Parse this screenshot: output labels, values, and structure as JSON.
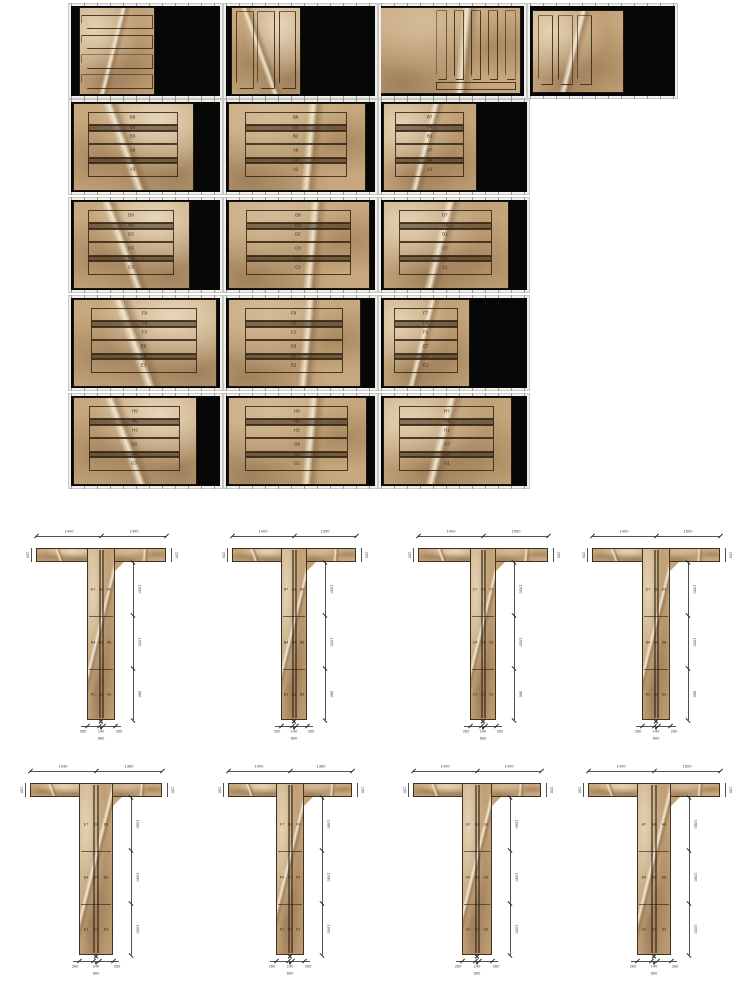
{
  "page": {
    "width": 750,
    "height": 1000,
    "background": "#ffffff",
    "description": "Stone cladding shop drawing: slab cutting layout sheets (top) and T-shaped column cladding elevations (bottom)"
  },
  "colors": {
    "slab_base": "#c7a87e",
    "slab_dark": "#8a6844",
    "slab_light": "#e8d9bc",
    "vein": "#f6ecd6",
    "outline": "#342512",
    "black_background": "#070707",
    "frame": "#f0efeb",
    "frame_tick": "#9a9a94",
    "dim_line": "#55504a",
    "dim_text": "#4a463f",
    "strip_label_text": "#33261a",
    "page_background": "#ffffff"
  },
  "slab_grid": {
    "rows": [
      {
        "kind": "unlabeled",
        "cells": [
          {
            "x": 68,
            "y": 3,
            "w": 155,
            "h": 96,
            "slab": {
              "l": 6,
              "t": 2,
              "w": 50,
              "h": 96
            },
            "shape": {
              "kind": "hstrips",
              "count": 4,
              "box": {
                "l": 2,
                "t": 8,
                "w": 96,
                "h": 86
              },
              "chamfer": "left"
            }
          },
          {
            "x": 223,
            "y": 3,
            "w": 155,
            "h": 96,
            "slab": {
              "l": 4,
              "t": 2,
              "w": 46,
              "h": 96
            },
            "shape": {
              "kind": "vstrips",
              "count": 3,
              "box": {
                "l": 6,
                "t": 4,
                "w": 88,
                "h": 90
              },
              "chamfer": "bottom"
            }
          },
          {
            "x": 378,
            "y": 3,
            "w": 149,
            "h": 96,
            "slab": {
              "l": 0,
              "t": 2,
              "w": 97,
              "h": 95
            },
            "shape": {
              "kind": "vstrips",
              "count": 5,
              "box": {
                "l": 40,
                "t": 3,
                "w": 57,
                "h": 82
              },
              "chamfer": "bottom",
              "base_bar": {
                "l": 40,
                "t": 87,
                "w": 57,
                "h": 9
              }
            }
          },
          {
            "x": 527,
            "y": 3,
            "w": 151,
            "h": 96,
            "slab": {
              "l": 2,
              "t": 5,
              "w": 62,
              "h": 90
            },
            "shape": {
              "kind": "vstrips",
              "count": 3,
              "box": {
                "l": 6,
                "t": 6,
                "w": 60,
                "h": 86
              },
              "chamfer": "bottom"
            }
          }
        ]
      },
      {
        "kind": "labeled",
        "cells": [
          {
            "x": 68,
            "y": 99,
            "w": 155,
            "h": 96,
            "slab": {
              "l": 2,
              "t": 2,
              "w": 80,
              "h": 96
            },
            "strips": [
              "B9",
              "B6",
              "B3",
              "A9",
              "A6",
              "A3"
            ]
          },
          {
            "x": 223,
            "y": 99,
            "w": 155,
            "h": 96,
            "slab": {
              "l": 2,
              "t": 2,
              "w": 91,
              "h": 96
            },
            "strips": [
              "B8",
              "B5",
              "B2",
              "A8",
              "A5",
              "A2"
            ]
          },
          {
            "x": 378,
            "y": 99,
            "w": 152,
            "h": 96,
            "slab": {
              "l": 2,
              "t": 2,
              "w": 63,
              "h": 96
            },
            "strips": [
              "B7",
              "B4",
              "B1",
              "A7",
              "A4",
              "A1"
            ]
          }
        ]
      },
      {
        "kind": "labeled",
        "cells": [
          {
            "x": 68,
            "y": 197,
            "w": 155,
            "h": 96,
            "slab": {
              "l": 2,
              "t": 2,
              "w": 77,
              "h": 96
            },
            "strips": [
              "D9",
              "D6",
              "D3",
              "C9",
              "C6",
              "C3"
            ]
          },
          {
            "x": 223,
            "y": 197,
            "w": 155,
            "h": 96,
            "slab": {
              "l": 2,
              "t": 2,
              "w": 94,
              "h": 96
            },
            "strips": [
              "D8",
              "D5",
              "D2",
              "C8",
              "C5",
              "C2"
            ]
          },
          {
            "x": 378,
            "y": 197,
            "w": 152,
            "h": 96,
            "slab": {
              "l": 2,
              "t": 2,
              "w": 85,
              "h": 96
            },
            "strips": [
              "D7",
              "D4",
              "D1",
              "C7",
              "C4",
              "C1"
            ]
          }
        ]
      },
      {
        "kind": "labeled",
        "cells": [
          {
            "x": 68,
            "y": 295,
            "w": 155,
            "h": 96,
            "slab": {
              "l": 2,
              "t": 2,
              "w": 95,
              "h": 96
            },
            "strips": [
              "F9",
              "F6",
              "F3",
              "E9",
              "E6",
              "E3"
            ]
          },
          {
            "x": 223,
            "y": 295,
            "w": 155,
            "h": 96,
            "slab": {
              "l": 2,
              "t": 2,
              "w": 88,
              "h": 96
            },
            "strips": [
              "F8",
              "F5",
              "F2",
              "E8",
              "E5",
              "E2"
            ]
          },
          {
            "x": 378,
            "y": 295,
            "w": 152,
            "h": 96,
            "slab": {
              "l": 2,
              "t": 2,
              "w": 58,
              "h": 96
            },
            "strips": [
              "F7",
              "F4",
              "F1",
              "E7",
              "E4",
              "E1"
            ]
          }
        ]
      },
      {
        "kind": "labeled",
        "cells": [
          {
            "x": 68,
            "y": 393,
            "w": 155,
            "h": 96,
            "slab": {
              "l": 2,
              "t": 2,
              "w": 82,
              "h": 96
            },
            "strips": [
              "H9",
              "H6",
              "H3",
              "G9",
              "G6",
              "G3"
            ]
          },
          {
            "x": 223,
            "y": 393,
            "w": 155,
            "h": 96,
            "slab": {
              "l": 2,
              "t": 2,
              "w": 92,
              "h": 96
            },
            "strips": [
              "H8",
              "H5",
              "H2",
              "G8",
              "G5",
              "G2"
            ]
          },
          {
            "x": 378,
            "y": 393,
            "w": 152,
            "h": 96,
            "slab": {
              "l": 2,
              "t": 2,
              "w": 87,
              "h": 96
            },
            "strips": [
              "H7",
              "H4",
              "H1",
              "G7",
              "G4",
              "G1"
            ]
          }
        ]
      }
    ]
  },
  "columns_section": {
    "rows": [
      {
        "tees": [
          {
            "x": 36,
            "y": 528,
            "w": 130,
            "h": 215,
            "stem_w": 28,
            "dims": {
              "left_arm": "1400",
              "right_arm": "1400",
              "flange": "150",
              "segments": [
                "1050",
                "1050",
                "980"
              ],
              "bottom": [
                "260",
                "140",
                "260"
              ],
              "total": "660"
            },
            "segments": [
              [
                "A7",
                "A8",
                "A9"
              ],
              [
                "A4",
                "A5",
                "A6"
              ],
              [
                "A1",
                "A2",
                "A3"
              ]
            ]
          },
          {
            "x": 232,
            "y": 528,
            "w": 124,
            "h": 215,
            "stem_w": 26,
            "dims": {
              "left_arm": "1400",
              "right_arm": "1350",
              "flange": "150",
              "segments": [
                "1050",
                "1050",
                "980"
              ],
              "bottom": [
                "260",
                "140",
                "260"
              ],
              "total": "660"
            },
            "segments": [
              [
                "B7",
                "B8",
                "B9"
              ],
              [
                "B4",
                "B5",
                "B6"
              ],
              [
                "B1",
                "B2",
                "B3"
              ]
            ]
          },
          {
            "x": 418,
            "y": 528,
            "w": 130,
            "h": 215,
            "stem_w": 26,
            "dims": {
              "left_arm": "1400",
              "right_arm": "1500",
              "flange": "150",
              "segments": [
                "1050",
                "1050",
                "980"
              ],
              "bottom": [
                "260",
                "140",
                "260"
              ],
              "total": "660"
            },
            "segments": [
              [
                "C7",
                "C8",
                "C9"
              ],
              [
                "C4",
                "C5",
                "C6"
              ],
              [
                "C1",
                "C2",
                "C3"
              ]
            ]
          },
          {
            "x": 592,
            "y": 528,
            "w": 128,
            "h": 215,
            "stem_w": 28,
            "dims": {
              "left_arm": "1400",
              "right_arm": "1500",
              "flange": "150",
              "segments": [
                "1050",
                "1050",
                "980"
              ],
              "bottom": [
                "260",
                "140",
                "260"
              ],
              "total": "660"
            },
            "segments": [
              [
                "D7",
                "D8",
                "D9"
              ],
              [
                "D4",
                "D5",
                "D6"
              ],
              [
                "D1",
                "D2",
                "D3"
              ]
            ]
          }
        ]
      },
      {
        "tees": [
          {
            "x": 30,
            "y": 763,
            "w": 132,
            "h": 215,
            "stem_w": 34,
            "dims": {
              "left_arm": "1430",
              "right_arm": "1380",
              "flange": "150",
              "segments": [
                "1080",
                "1080",
                "1000"
              ],
              "bottom": [
                "260",
                "140",
                "260"
              ],
              "total": "660"
            },
            "segments": [
              [
                "E7",
                "E8",
                "E9"
              ],
              [
                "E4",
                "E5",
                "E6"
              ],
              [
                "E1",
                "E2",
                "E3"
              ]
            ]
          },
          {
            "x": 228,
            "y": 763,
            "w": 124,
            "h": 215,
            "stem_w": 28,
            "dims": {
              "left_arm": "1400",
              "right_arm": "1380",
              "flange": "150",
              "segments": [
                "1080",
                "1080",
                "1000"
              ],
              "bottom": [
                "260",
                "140",
                "260"
              ],
              "total": "660"
            },
            "segments": [
              [
                "F7",
                "F8",
                "F9"
              ],
              [
                "F4",
                "F5",
                "F6"
              ],
              [
                "F1",
                "F2",
                "F3"
              ]
            ]
          },
          {
            "x": 413,
            "y": 763,
            "w": 128,
            "h": 215,
            "stem_w": 30,
            "dims": {
              "left_arm": "1400",
              "right_arm": "1400",
              "flange": "150",
              "segments": [
                "1080",
                "1080",
                "1000"
              ],
              "bottom": [
                "260",
                "140",
                "260"
              ],
              "total": "660"
            },
            "segments": [
              [
                "G7",
                "G8",
                "G9"
              ],
              [
                "G4",
                "G5",
                "G6"
              ],
              [
                "G1",
                "G2",
                "G3"
              ]
            ]
          },
          {
            "x": 588,
            "y": 763,
            "w": 132,
            "h": 215,
            "stem_w": 34,
            "dims": {
              "left_arm": "1400",
              "right_arm": "1500",
              "flange": "150",
              "segments": [
                "1080",
                "1080",
                "1000"
              ],
              "bottom": [
                "260",
                "140",
                "260"
              ],
              "total": "660"
            },
            "segments": [
              [
                "H7",
                "H8",
                "H9"
              ],
              [
                "H4",
                "H5",
                "H6"
              ],
              [
                "H1",
                "H2",
                "H3"
              ]
            ]
          }
        ]
      }
    ]
  }
}
